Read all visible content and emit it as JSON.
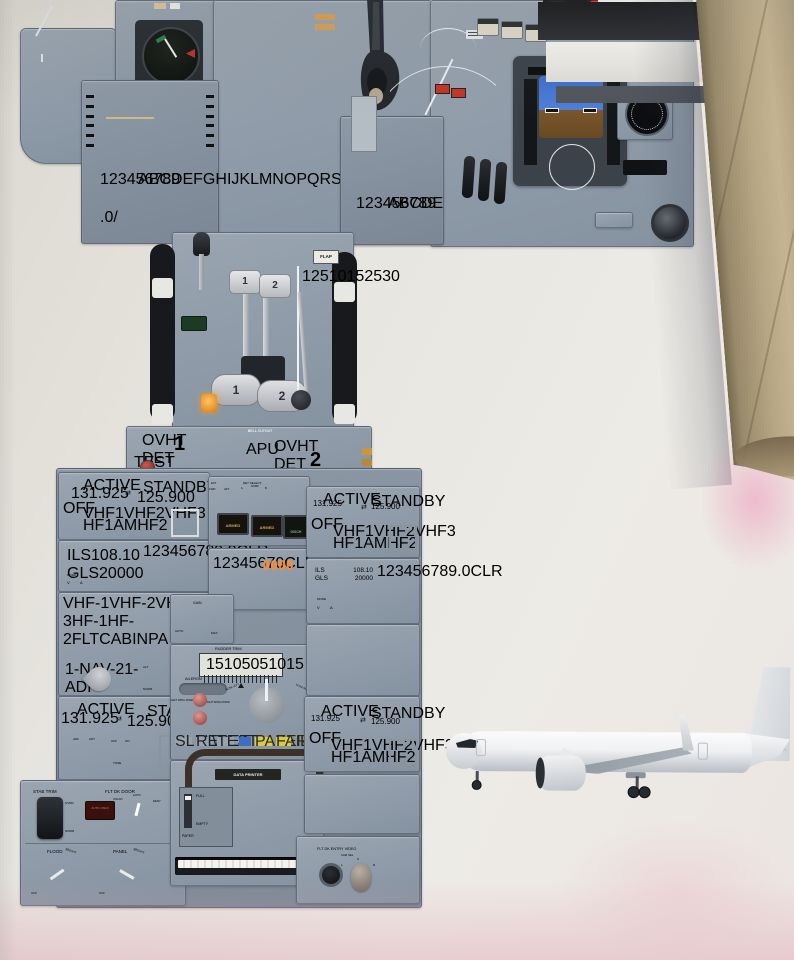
{
  "colors": {
    "panel_gray": "#94a0ac",
    "screen_black": "#171c15",
    "fire_red": "#b5322a",
    "lcd_digits": "#7e1b10",
    "lcd_window": "#e6dcc2",
    "amber_digits": "#ffa93c",
    "tube_kraft": "#b3a383",
    "pink_reflection": "#eeb0c8"
  },
  "cdu": {
    "letters": "ABCDEFGHIJKLMNOPQRSTUVWXYZ",
    "digits": "123456789",
    "symbols": [
      ".",
      "0",
      "/"
    ]
  },
  "quadrant": {
    "flap": "FLAP",
    "detents": [
      "1",
      "2",
      "5",
      "10",
      "15",
      "25",
      "30"
    ],
    "lever1": "1",
    "lever2": "2",
    "rev1": "1",
    "rev2": "2"
  },
  "fire": {
    "bell": "BELL CUTOUT",
    "ovht_l": "OVHT DET",
    "ovht_r": "OVHT DET",
    "test": "TEST",
    "h1": "1",
    "apu": "APU",
    "h2": "2"
  },
  "comm": {
    "active": "ACTIVE",
    "standby": "STANDBY",
    "freq_active": "131.925",
    "freq_standby": "125.900",
    "row1": [
      "VHF1",
      "VHF2",
      "VHF3"
    ],
    "row2": [
      "HF1",
      "AM",
      "HF2"
    ],
    "off": "OFF"
  },
  "nav": {
    "l1a": "ILS",
    "l1b": "108.10",
    "l2a": "GLS",
    "l2b": "20000",
    "keys": [
      "1",
      "2",
      "3",
      "4",
      "5",
      "6",
      "7",
      "8",
      "9",
      ".",
      "0",
      "CLR"
    ],
    "mode": "MODE",
    "v": "V",
    "a": "A"
  },
  "acp": {
    "mics": [
      "VHF-1",
      "VHF-2",
      "VHF-3",
      "HF-1",
      "HF-2",
      "FLT",
      "CABIN",
      "PA"
    ],
    "knob_labels": [
      "1-NAV-2",
      "1-ADF-2",
      "MKR",
      "SPKR"
    ],
    "alt": "ALT",
    "norm": "NORM",
    "mic_count": 8,
    "vol1": 8,
    "vol2": 6
  },
  "adf": {
    "active": "ACTIVE",
    "standby": "STANDBY",
    "freq_active": "131.925",
    "freq_standby": "125.900",
    "adf": "ADF",
    "ant": "ANT",
    "off": "OFF",
    "on": "ON",
    "tone": "TONE"
  },
  "cargo": {
    "det": "DET SELECT",
    "ext": "EXT",
    "fwd": "FWD",
    "aft": "AFT",
    "a": "A",
    "norm": "NORM",
    "b": "B",
    "armed_fwd": "ARMED",
    "armed_aft": "ARMED",
    "disch": "DISCH"
  },
  "xpdr": {
    "code": "0000",
    "keys": [
      "1",
      "2",
      "3",
      "4",
      "5",
      "6",
      "7",
      "0",
      "CLR"
    ]
  },
  "wxr": {
    "gain": "GAIN",
    "auto": "AUTO",
    "max": "MAX"
  },
  "trim": {
    "rudder": "RUDDER TRIM",
    "scale": [
      "15",
      "10",
      "5",
      "0",
      "5",
      "10",
      "15"
    ],
    "aileron": "AILERON",
    "lwd": "LEFT WING DOWN",
    "rwd": "RIGHT WING DOWN",
    "nl": "NOSE LEFT",
    "nr": "NOSE RIGHT"
  },
  "printer": {
    "slew": "SLEW",
    "reset": "RESET",
    "test": "TEST",
    "paper_btn": "PAPER",
    "fail": "FAIL",
    "title": "DATA PRINTER",
    "full": "FULL",
    "empty": "EMPTY",
    "paper": "PAPER"
  },
  "aft": {
    "stab": "STAB TRIM",
    "ovrd": "OVRD",
    "norm": "NORM",
    "door": "FLT DK DOOR",
    "unlkd": "UNLKD",
    "auto": "AUTO",
    "deny": "DENY",
    "auto_unlk": "AUTO UNLK",
    "flood": "FLOOD",
    "panel": "PANEL",
    "off": "OFF",
    "bright": "BRIGHT"
  },
  "video": {
    "title": "FLT DK ENTRY VIDEO",
    "cam": "CAM SEL",
    "l": "L",
    "s": "S",
    "r": "R"
  },
  "plane": {
    "windows": 40
  }
}
